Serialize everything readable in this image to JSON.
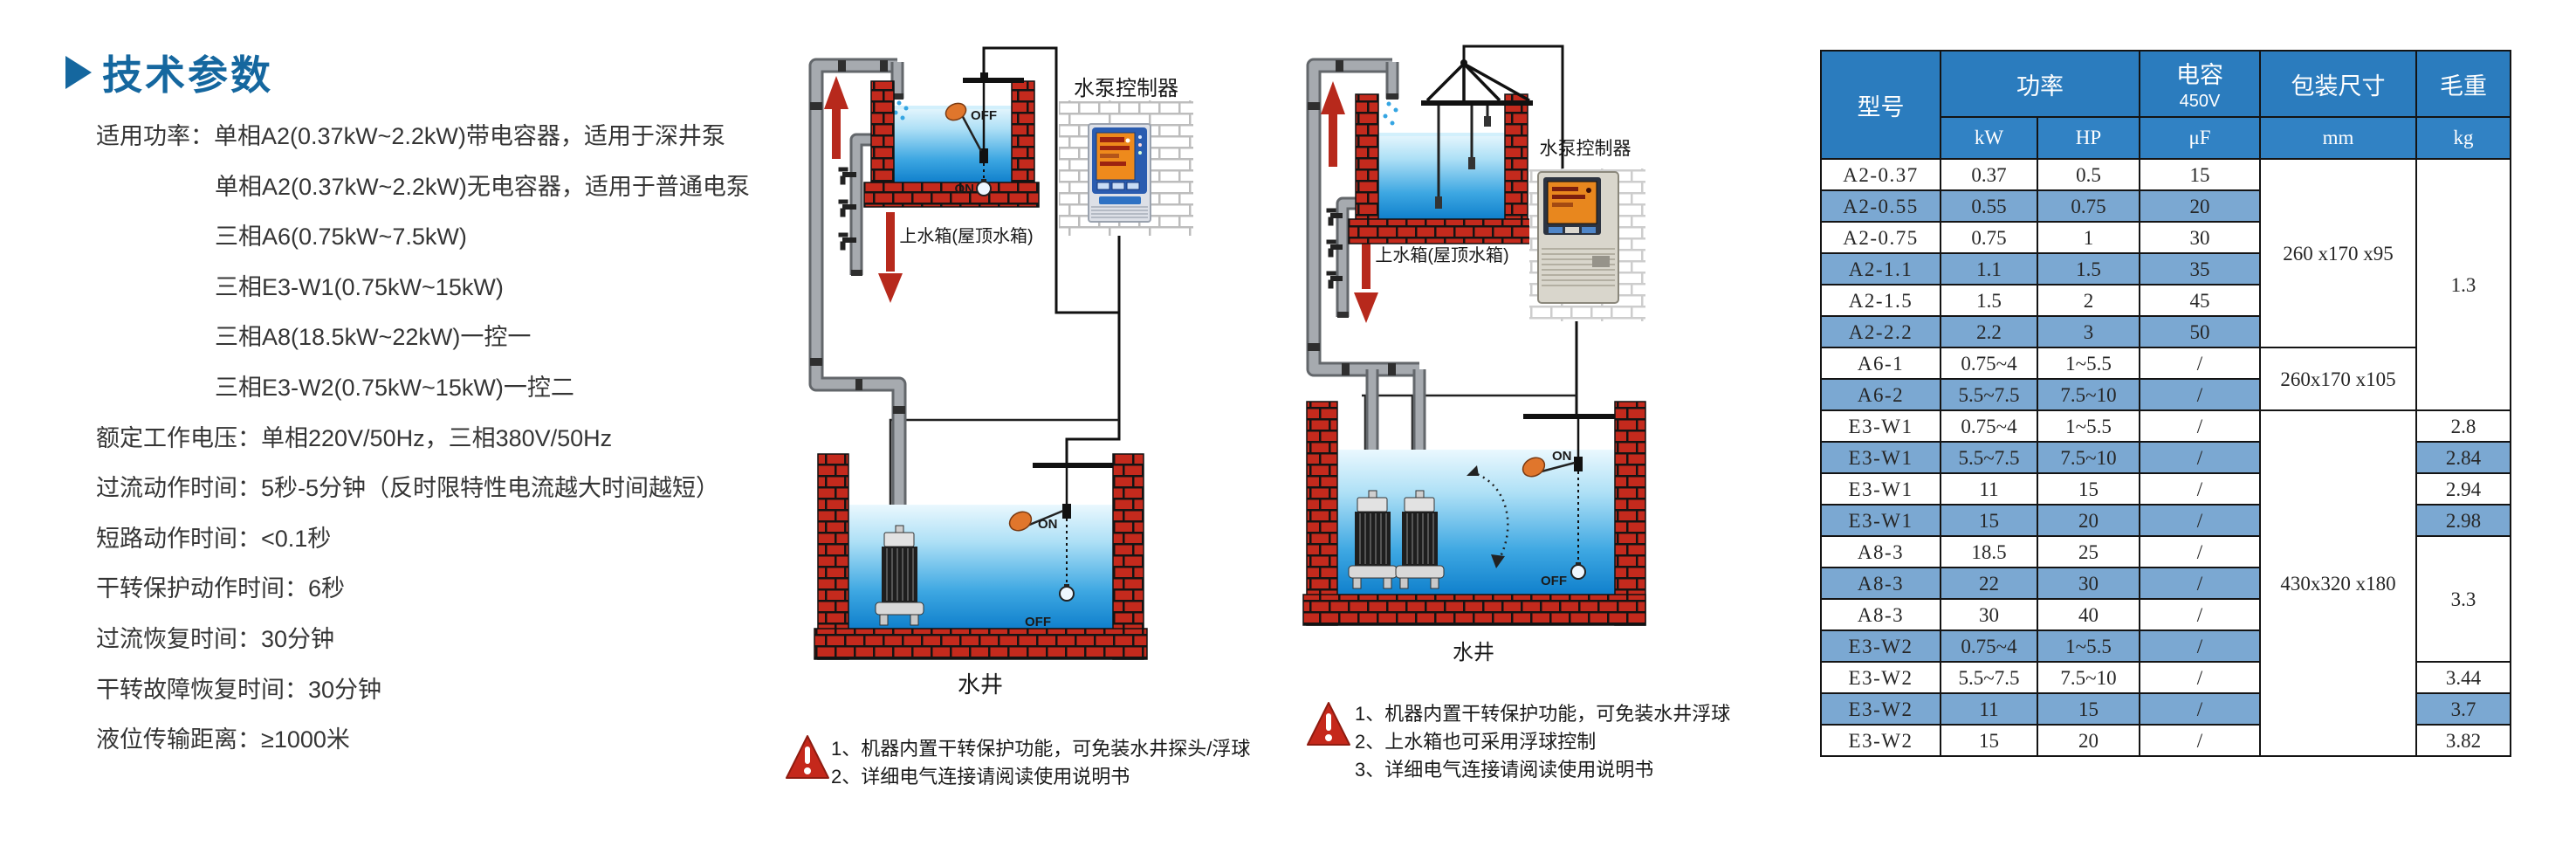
{
  "title": {
    "text": "技术参数"
  },
  "colors": {
    "accent_blue": "#15679f",
    "table_header_blue": "#2b7cbe",
    "table_row_blue": "#7ba8d2",
    "brick_red": "#c42a1d",
    "warning_red": "#c5281b",
    "water_blue": "#1080cc",
    "float_orange": "#e0762c",
    "arrow_red": "#b7291c"
  },
  "specs": [
    {
      "text": "适用功率：单相A2(0.37kW~2.2kW)带电容器，适用于深井泵"
    },
    {
      "text": "单相A2(0.37kW~2.2kW)无电容器，适用于普通电泵"
    },
    {
      "text": "三相A6(0.75kW~7.5kW)"
    },
    {
      "text": "三相E3-W1(0.75kW~15kW)"
    },
    {
      "text": "三相A8(18.5kW~22kW)一控一"
    },
    {
      "text": "三相E3-W2(0.75kW~15kW)一控二"
    },
    {
      "text": "额定工作电压：单相220V/50Hz，三相380V/50Hz"
    },
    {
      "text": "过流动作时间：5秒-5分钟（反时限特性电流越大时间越短）"
    },
    {
      "text": "短路动作时间：<0.1秒"
    },
    {
      "text": "干转保护动作时间：6秒"
    },
    {
      "text": "过流恢复时间：30分钟"
    },
    {
      "text": "干转故障恢复时间：30分钟"
    },
    {
      "text": "液位传输距离：≥1000米"
    }
  ],
  "diagram1": {
    "controller_label": "水泵控制器",
    "tank_label": "上水箱(屋顶水箱)",
    "well_label": "水井",
    "on": "ON",
    "off": "OFF",
    "notes": [
      "1、机器内置干转保护功能，可免装水井探头/浮球",
      "2、详细电气连接请阅读使用说明书"
    ]
  },
  "diagram2": {
    "controller_label": "水泵控制器",
    "tank_label": "上水箱(屋顶水箱)",
    "well_label": "水井",
    "on": "ON",
    "off": "OFF",
    "notes": [
      "1、机器内置干转保护功能，可免装水井浮球",
      "2、上水箱也可采用浮球控制",
      "3、详细电气连接请阅读使用说明书"
    ]
  },
  "table": {
    "headers": {
      "model": "型号",
      "power": "功率",
      "power_kw": "kW",
      "power_hp": "HP",
      "capacitor_line1": "电容",
      "capacitor_line2": "450V",
      "capacitor_unit": "μF",
      "packing": "包装尺寸",
      "packing_unit": "mm",
      "weight": "毛重",
      "weight_unit": "kg"
    },
    "rows": [
      {
        "model": "A2-0.37",
        "kw": "0.37",
        "hp": "0.5",
        "uf": "15"
      },
      {
        "model": "A2-0.55",
        "kw": "0.55",
        "hp": "0.75",
        "uf": "20"
      },
      {
        "model": "A2-0.75",
        "kw": "0.75",
        "hp": "1",
        "uf": "30"
      },
      {
        "model": "A2-1.1",
        "kw": "1.1",
        "hp": "1.5",
        "uf": "35"
      },
      {
        "model": "A2-1.5",
        "kw": "1.5",
        "hp": "2",
        "uf": "45"
      },
      {
        "model": "A2-2.2",
        "kw": "2.2",
        "hp": "3",
        "uf": "50"
      },
      {
        "model": "A6-1",
        "kw": "0.75~4",
        "hp": "1~5.5",
        "uf": "/"
      },
      {
        "model": "A6-2",
        "kw": "5.5~7.5",
        "hp": "7.5~10",
        "uf": "/"
      },
      {
        "model": "E3-W1",
        "kw": "0.75~4",
        "hp": "1~5.5",
        "uf": "/",
        "weight": "2.8"
      },
      {
        "model": "E3-W1",
        "kw": "5.5~7.5",
        "hp": "7.5~10",
        "uf": "/",
        "weight": "2.84"
      },
      {
        "model": "E3-W1",
        "kw": "11",
        "hp": "15",
        "uf": "/",
        "weight": "2.94"
      },
      {
        "model": "E3-W1",
        "kw": "15",
        "hp": "20",
        "uf": "/",
        "weight": "2.98"
      },
      {
        "model": "A8-3",
        "kw": "18.5",
        "hp": "25",
        "uf": "/"
      },
      {
        "model": "A8-3",
        "kw": "22",
        "hp": "30",
        "uf": "/"
      },
      {
        "model": "A8-3",
        "kw": "30",
        "hp": "40",
        "uf": "/"
      },
      {
        "model": "E3-W2",
        "kw": "0.75~4",
        "hp": "1~5.5",
        "uf": "/"
      },
      {
        "model": "E3-W2",
        "kw": "5.5~7.5",
        "hp": "7.5~10",
        "uf": "/",
        "weight": "3.44"
      },
      {
        "model": "E3-W2",
        "kw": "11",
        "hp": "15",
        "uf": "/",
        "weight": "3.7"
      },
      {
        "model": "E3-W2",
        "kw": "15",
        "hp": "20",
        "uf": "/",
        "weight": "3.82"
      }
    ],
    "merged": {
      "packing": [
        {
          "text": "260 x170 x95",
          "from": 0,
          "span": 6
        },
        {
          "text": "260x170 x105",
          "from": 6,
          "span": 2
        },
        {
          "text": "430x320 x180",
          "from": 8,
          "span": 11
        }
      ],
      "weight": [
        {
          "text": "1.3",
          "from": 0,
          "span": 8
        },
        {
          "text": "3.3",
          "from": 12,
          "span": 4
        }
      ]
    }
  }
}
